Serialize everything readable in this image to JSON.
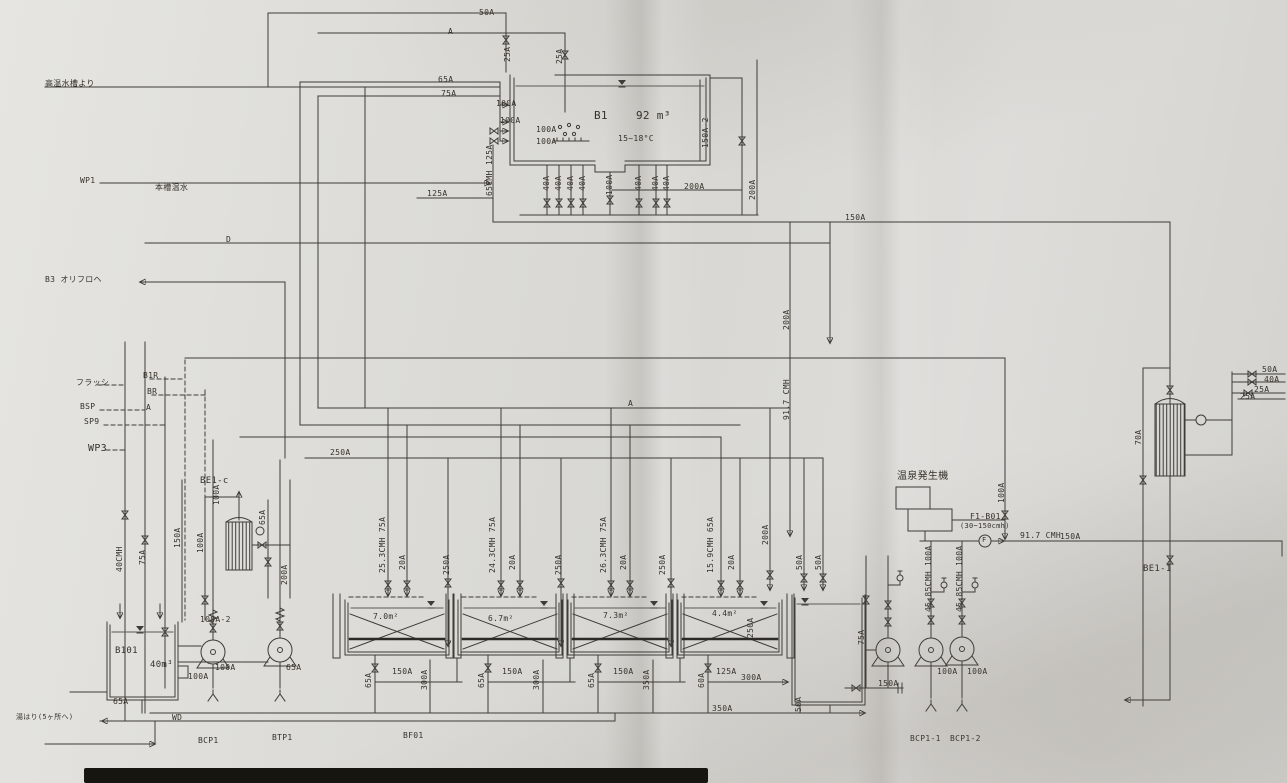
{
  "document": {
    "type_note": "scanned piping & instrumentation drawing",
    "accent_color": "#3e3c37",
    "paper_color": "#dddcd8"
  },
  "labels": [
    {
      "t": "50A",
      "x": 479,
      "y": 9
    },
    {
      "t": "A",
      "x": 448,
      "y": 28
    },
    {
      "t": "65A",
      "x": 438,
      "y": 76
    },
    {
      "t": "75A",
      "x": 441,
      "y": 90
    },
    {
      "t": "25A",
      "x": 504,
      "y": 62,
      "r": 1
    },
    {
      "t": "25A",
      "x": 556,
      "y": 64,
      "r": 1
    },
    {
      "t": "100A",
      "x": 496,
      "y": 100
    },
    {
      "t": "100A",
      "x": 500,
      "y": 117
    },
    {
      "t": "100A",
      "x": 536,
      "y": 126
    },
    {
      "t": "100A",
      "x": 536,
      "y": 138
    },
    {
      "t": "B1",
      "x": 594,
      "y": 110,
      "s": 11,
      "n": "tank-b1-tag"
    },
    {
      "t": "92 m³",
      "x": 636,
      "y": 110,
      "s": 11,
      "n": "tank-b1-capacity"
    },
    {
      "t": "15~18°C",
      "x": 618,
      "y": 135,
      "n": "tank-b1-temperature"
    },
    {
      "t": "150A-2",
      "x": 702,
      "y": 148,
      "r": 1
    },
    {
      "t": "125A",
      "x": 486,
      "y": 165,
      "r": 1
    },
    {
      "t": "65CMH",
      "x": 486,
      "y": 196,
      "r": 1,
      "n": "flow-rate-label"
    },
    {
      "t": "125A",
      "x": 427,
      "y": 190
    },
    {
      "t": "40A",
      "x": 543,
      "y": 191,
      "r": 1
    },
    {
      "t": "40A",
      "x": 555,
      "y": 191,
      "r": 1
    },
    {
      "t": "40A",
      "x": 567,
      "y": 191,
      "r": 1
    },
    {
      "t": "40A",
      "x": 579,
      "y": 191,
      "r": 1
    },
    {
      "t": "100A",
      "x": 606,
      "y": 195,
      "r": 1
    },
    {
      "t": "40A",
      "x": 635,
      "y": 191,
      "r": 1
    },
    {
      "t": "40A",
      "x": 652,
      "y": 191,
      "r": 1
    },
    {
      "t": "40A",
      "x": 663,
      "y": 191,
      "r": 1
    },
    {
      "t": "200A",
      "x": 684,
      "y": 183
    },
    {
      "t": "200A",
      "x": 749,
      "y": 200,
      "r": 1
    },
    {
      "t": "150A",
      "x": 845,
      "y": 214
    },
    {
      "t": "高温水槽より",
      "x": 45,
      "y": 80,
      "n": "line-source-note"
    },
    {
      "t": "WP1",
      "x": 80,
      "y": 177,
      "n": "line-tag"
    },
    {
      "t": "本槽温水",
      "x": 155,
      "y": 184,
      "n": "line-note"
    },
    {
      "t": "B3 オリフロヘ",
      "x": 45,
      "y": 276,
      "n": "line-tag"
    },
    {
      "t": "D",
      "x": 226,
      "y": 236
    },
    {
      "t": "フラッシ",
      "x": 76,
      "y": 379,
      "n": "line-tag"
    },
    {
      "t": "B1R",
      "x": 143,
      "y": 372,
      "n": "line-tag"
    },
    {
      "t": "BR",
      "x": 147,
      "y": 388,
      "n": "line-tag"
    },
    {
      "t": "BSP",
      "x": 80,
      "y": 403,
      "n": "line-tag"
    },
    {
      "t": "A",
      "x": 146,
      "y": 404
    },
    {
      "t": "SP9",
      "x": 84,
      "y": 418,
      "n": "line-tag"
    },
    {
      "t": "WP3",
      "x": 88,
      "y": 444,
      "s": 10,
      "n": "line-tag"
    },
    {
      "t": "40CMH",
      "x": 116,
      "y": 572,
      "r": 1,
      "n": "flow-rate-label"
    },
    {
      "t": "75A",
      "x": 139,
      "y": 565,
      "r": 1
    },
    {
      "t": "BE1-c",
      "x": 200,
      "y": 477,
      "s": 9,
      "n": "heat-exchanger-tag"
    },
    {
      "t": "100A",
      "x": 213,
      "y": 505,
      "r": 1
    },
    {
      "t": "150A",
      "x": 174,
      "y": 548,
      "r": 1
    },
    {
      "t": "100A",
      "x": 197,
      "y": 553,
      "r": 1
    },
    {
      "t": "65A",
      "x": 259,
      "y": 525,
      "r": 1
    },
    {
      "t": "200A",
      "x": 281,
      "y": 585,
      "r": 1
    },
    {
      "t": "250A",
      "x": 330,
      "y": 449
    },
    {
      "t": "A",
      "x": 628,
      "y": 400
    },
    {
      "t": "200A",
      "x": 783,
      "y": 330,
      "r": 1
    },
    {
      "t": "91.7 CMH",
      "x": 783,
      "y": 420,
      "r": 1,
      "n": "flow-rate-label"
    },
    {
      "t": "25.3CMH 75A",
      "x": 379,
      "y": 573,
      "r": 1,
      "n": "flow-rate-label"
    },
    {
      "t": "20A",
      "x": 399,
      "y": 570,
      "r": 1
    },
    {
      "t": "250A",
      "x": 443,
      "y": 575,
      "r": 1
    },
    {
      "t": "24.3CMH 75A",
      "x": 489,
      "y": 573,
      "r": 1,
      "n": "flow-rate-label"
    },
    {
      "t": "20A",
      "x": 509,
      "y": 570,
      "r": 1
    },
    {
      "t": "250A",
      "x": 555,
      "y": 575,
      "r": 1
    },
    {
      "t": "26.3CMH 75A",
      "x": 600,
      "y": 573,
      "r": 1,
      "n": "flow-rate-label"
    },
    {
      "t": "20A",
      "x": 620,
      "y": 570,
      "r": 1
    },
    {
      "t": "250A",
      "x": 659,
      "y": 575,
      "r": 1
    },
    {
      "t": "15.9CMH 65A",
      "x": 707,
      "y": 573,
      "r": 1,
      "n": "flow-rate-label"
    },
    {
      "t": "20A",
      "x": 728,
      "y": 570,
      "r": 1
    },
    {
      "t": "200A",
      "x": 762,
      "y": 545,
      "r": 1
    },
    {
      "t": "50A",
      "x": 796,
      "y": 570,
      "r": 1
    },
    {
      "t": "50A",
      "x": 815,
      "y": 570,
      "r": 1
    },
    {
      "t": "7.0m²",
      "x": 373,
      "y": 613,
      "n": "filter-area"
    },
    {
      "t": "6.7m²",
      "x": 488,
      "y": 615,
      "n": "filter-area"
    },
    {
      "t": "7.3m²",
      "x": 603,
      "y": 612,
      "n": "filter-area"
    },
    {
      "t": "4.4m²",
      "x": 712,
      "y": 610,
      "n": "filter-area"
    },
    {
      "t": "250A",
      "x": 747,
      "y": 638,
      "r": 1
    },
    {
      "t": "65A",
      "x": 365,
      "y": 688,
      "r": 1
    },
    {
      "t": "150A",
      "x": 392,
      "y": 668
    },
    {
      "t": "300A",
      "x": 421,
      "y": 690,
      "r": 1
    },
    {
      "t": "65A",
      "x": 478,
      "y": 688,
      "r": 1
    },
    {
      "t": "150A",
      "x": 502,
      "y": 668
    },
    {
      "t": "300A",
      "x": 533,
      "y": 690,
      "r": 1
    },
    {
      "t": "65A",
      "x": 588,
      "y": 688,
      "r": 1
    },
    {
      "t": "150A",
      "x": 613,
      "y": 668
    },
    {
      "t": "350A",
      "x": 643,
      "y": 690,
      "r": 1
    },
    {
      "t": "60A",
      "x": 698,
      "y": 688,
      "r": 1
    },
    {
      "t": "125A",
      "x": 716,
      "y": 668
    },
    {
      "t": "300A",
      "x": 741,
      "y": 674
    },
    {
      "t": "350A",
      "x": 712,
      "y": 705
    },
    {
      "t": "50A",
      "x": 795,
      "y": 712,
      "r": 1
    },
    {
      "t": "100A-2",
      "x": 200,
      "y": 616
    },
    {
      "t": "B101",
      "x": 115,
      "y": 647,
      "s": 9,
      "n": "tank-b101-tag"
    },
    {
      "t": "40m³",
      "x": 150,
      "y": 661,
      "s": 9,
      "n": "tank-b101-capacity"
    },
    {
      "t": "100A",
      "x": 215,
      "y": 664
    },
    {
      "t": "65A",
      "x": 286,
      "y": 664
    },
    {
      "t": "100A",
      "x": 188,
      "y": 673
    },
    {
      "t": "65A",
      "x": 113,
      "y": 698
    },
    {
      "t": "WD",
      "x": 172,
      "y": 714,
      "n": "line-tag"
    },
    {
      "t": "湯はり(5ヶ所へ)",
      "x": 16,
      "y": 714,
      "s": 7,
      "n": "line-note"
    },
    {
      "t": "BCP1",
      "x": 198,
      "y": 737,
      "n": "pump-tag"
    },
    {
      "t": "BTP1",
      "x": 272,
      "y": 734,
      "n": "pump-tag"
    },
    {
      "t": "BF01",
      "x": 403,
      "y": 732,
      "n": "equipment-tag"
    },
    {
      "t": "温泉発生機",
      "x": 897,
      "y": 472,
      "s": 10,
      "n": "generator-label"
    },
    {
      "t": "F1-B01",
      "x": 970,
      "y": 513,
      "n": "flow-meter-tag"
    },
    {
      "t": "(30~150cmh)",
      "x": 960,
      "y": 523,
      "s": 7,
      "n": "flow-meter-range"
    },
    {
      "t": "F",
      "x": 982,
      "y": 537,
      "s": 7,
      "n": "flow-meter-letter"
    },
    {
      "t": "91.7 CMH",
      "x": 1020,
      "y": 532,
      "n": "flow-rate-label"
    },
    {
      "t": "150A",
      "x": 1060,
      "y": 533
    },
    {
      "t": "100A",
      "x": 998,
      "y": 503,
      "r": 1
    },
    {
      "t": "45.85CMH 100A",
      "x": 925,
      "y": 612,
      "r": 1,
      "n": "flow-rate-label"
    },
    {
      "t": "45.85CMH 100A",
      "x": 956,
      "y": 612,
      "r": 1,
      "n": "flow-rate-label"
    },
    {
      "t": "75A",
      "x": 858,
      "y": 645,
      "r": 1
    },
    {
      "t": "150A",
      "x": 878,
      "y": 680
    },
    {
      "t": "100A",
      "x": 937,
      "y": 668
    },
    {
      "t": "100A",
      "x": 967,
      "y": 668
    },
    {
      "t": "BCP1-1",
      "x": 910,
      "y": 735,
      "n": "pump-tag"
    },
    {
      "t": "BCP1-2",
      "x": 950,
      "y": 735,
      "n": "pump-tag"
    },
    {
      "t": "70A",
      "x": 1135,
      "y": 445,
      "r": 1
    },
    {
      "t": "50A",
      "x": 1262,
      "y": 366
    },
    {
      "t": "40A",
      "x": 1264,
      "y": 376
    },
    {
      "t": "25A",
      "x": 1254,
      "y": 386
    },
    {
      "t": "25A",
      "x": 1240,
      "y": 393
    },
    {
      "t": "BE1-1",
      "x": 1143,
      "y": 565,
      "s": 9,
      "n": "heat-exchanger-tag"
    }
  ]
}
